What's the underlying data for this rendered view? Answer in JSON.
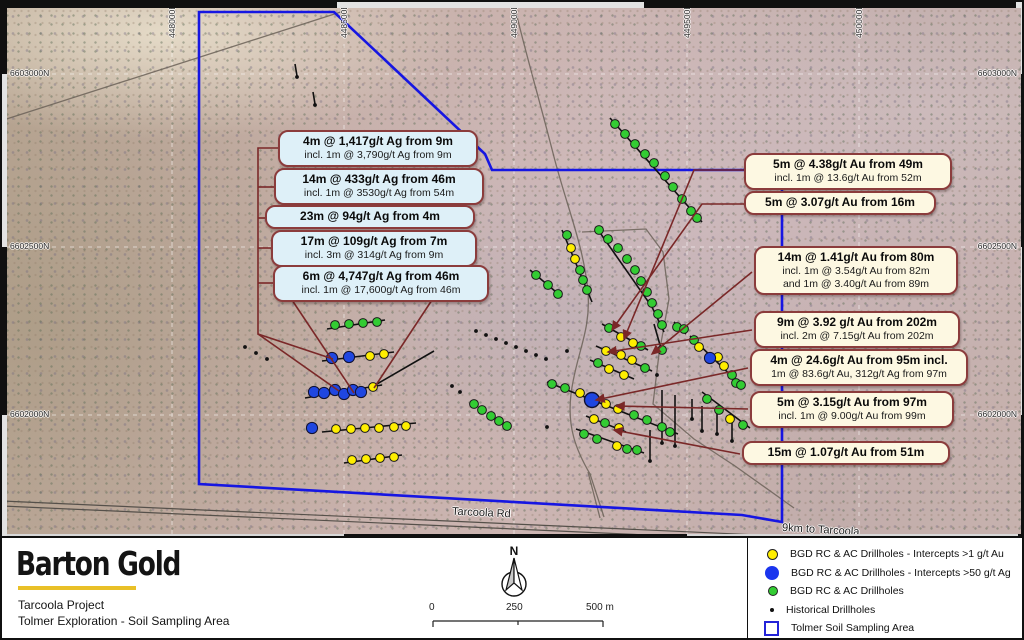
{
  "map": {
    "road_label": "Tarcoola Rd",
    "distance_label": "9km to Tarcoola",
    "grid": {
      "v": [
        170,
        342,
        512,
        685,
        857
      ],
      "h": [
        72,
        245,
        413
      ],
      "top_labels": [
        {
          "t": "448000E",
          "x": 170
        },
        {
          "t": "448500E",
          "x": 342
        },
        {
          "t": "449000E",
          "x": 512
        },
        {
          "t": "449500E",
          "x": 685
        },
        {
          "t": "450000E",
          "x": 857
        }
      ],
      "side_labels": [
        {
          "t": "6603000N",
          "y": 72
        },
        {
          "t": "6602500N",
          "y": 245
        },
        {
          "t": "6602000N",
          "y": 413
        }
      ]
    },
    "colors": {
      "boundary": "#1616e2",
      "leader": "#7a2828",
      "green_dot": "#33cc33",
      "yellow_dot": "#ffee00",
      "blue_dot": "#1f46e0",
      "historical_dot": "#111111"
    },
    "boundary_points": "197,10 332,10 483,152 490,168 780,168 780,520 740,513 197,482",
    "roads": [
      "M -5,120 L 345,8",
      "M 513,6 C 522,45 538,100 552,155 C 565,205 582,245 586,290 C 589,330 574,352 569,392 C 565,425 574,448 588,472 L 602,515",
      "M 580,230 L 644,227 L 661,250 L 667,297 L 657,352 L 651,402 L 692,437 L 733,464 L 792,506",
      "M 586,470 L 598,516"
    ],
    "main_road": [
      "M 0,499 L 1024,545",
      "M 0,504 L 1024,550"
    ],
    "traverses": [
      [
        325,
        327,
        383,
        318
      ],
      [
        320,
        359,
        392,
        350
      ],
      [
        303,
        396,
        380,
        383
      ],
      [
        368,
        386,
        432,
        349
      ],
      [
        320,
        430,
        414,
        421
      ],
      [
        342,
        461,
        400,
        453
      ],
      [
        608,
        116,
        700,
        220
      ],
      [
        560,
        228,
        590,
        300
      ],
      [
        594,
        225,
        650,
        305
      ],
      [
        650,
        305,
        662,
        330
      ],
      [
        528,
        268,
        560,
        295
      ],
      [
        600,
        322,
        646,
        348
      ],
      [
        652,
        322,
        660,
        350
      ],
      [
        672,
        320,
        684,
        332
      ],
      [
        688,
        334,
        742,
        386
      ],
      [
        594,
        344,
        650,
        369
      ],
      [
        588,
        358,
        632,
        377
      ],
      [
        545,
        380,
        676,
        432
      ],
      [
        584,
        414,
        624,
        430
      ],
      [
        574,
        427,
        642,
        451
      ],
      [
        700,
        390,
        748,
        426
      ],
      [
        660,
        388,
        660,
        440
      ],
      [
        673,
        393,
        673,
        443
      ],
      [
        690,
        397,
        690,
        416
      ],
      [
        700,
        404,
        700,
        428
      ],
      [
        715,
        407,
        715,
        431
      ],
      [
        730,
        414,
        730,
        438
      ],
      [
        648,
        428,
        648,
        458
      ],
      [
        293,
        62,
        295,
        74
      ],
      [
        311,
        90,
        313,
        102
      ]
    ],
    "drillholes": {
      "green": [
        [
          613,
          122
        ],
        [
          623,
          132
        ],
        [
          633,
          142
        ],
        [
          643,
          152
        ],
        [
          652,
          161
        ],
        [
          663,
          174
        ],
        [
          671,
          185
        ],
        [
          680,
          197
        ],
        [
          689,
          209
        ],
        [
          695,
          216
        ],
        [
          597,
          228
        ],
        [
          606,
          237
        ],
        [
          616,
          246
        ],
        [
          625,
          257
        ],
        [
          633,
          268
        ],
        [
          639,
          279
        ],
        [
          645,
          290
        ],
        [
          650,
          301
        ],
        [
          656,
          312
        ],
        [
          565,
          233
        ],
        [
          578,
          268
        ],
        [
          581,
          278
        ],
        [
          585,
          288
        ],
        [
          534,
          273
        ],
        [
          546,
          283
        ],
        [
          556,
          292
        ],
        [
          607,
          326
        ],
        [
          639,
          344
        ],
        [
          660,
          323
        ],
        [
          675,
          325
        ],
        [
          682,
          327
        ],
        [
          692,
          338
        ],
        [
          730,
          373
        ],
        [
          734,
          381
        ],
        [
          739,
          383
        ],
        [
          596,
          361
        ],
        [
          643,
          366
        ],
        [
          550,
          382
        ],
        [
          563,
          386
        ],
        [
          632,
          413
        ],
        [
          645,
          418
        ],
        [
          660,
          425
        ],
        [
          668,
          430
        ],
        [
          603,
          421
        ],
        [
          582,
          432
        ],
        [
          595,
          437
        ],
        [
          625,
          447
        ],
        [
          635,
          448
        ],
        [
          705,
          397
        ],
        [
          717,
          408
        ],
        [
          741,
          423
        ],
        [
          660,
          348
        ],
        [
          333,
          323
        ],
        [
          347,
          322
        ],
        [
          361,
          321
        ],
        [
          375,
          320
        ],
        [
          472,
          402
        ],
        [
          480,
          408
        ],
        [
          489,
          414
        ],
        [
          497,
          419
        ],
        [
          505,
          424
        ]
      ],
      "yellow": [
        [
          569,
          246
        ],
        [
          573,
          257
        ],
        [
          619,
          335
        ],
        [
          631,
          341
        ],
        [
          604,
          349
        ],
        [
          619,
          353
        ],
        [
          630,
          358
        ],
        [
          607,
          367
        ],
        [
          622,
          373
        ],
        [
          578,
          391
        ],
        [
          604,
          402
        ],
        [
          616,
          407
        ],
        [
          592,
          417
        ],
        [
          617,
          426
        ],
        [
          615,
          444
        ],
        [
          697,
          345
        ],
        [
          716,
          355
        ],
        [
          722,
          364
        ],
        [
          728,
          417
        ],
        [
          368,
          354
        ],
        [
          382,
          352
        ],
        [
          371,
          385
        ],
        [
          334,
          427
        ],
        [
          349,
          427
        ],
        [
          363,
          426
        ],
        [
          377,
          426
        ],
        [
          392,
          425
        ],
        [
          404,
          424
        ],
        [
          350,
          458
        ],
        [
          364,
          457
        ],
        [
          378,
          456
        ],
        [
          392,
          455
        ]
      ],
      "blue": [
        [
          330,
          356
        ],
        [
          347,
          355
        ],
        [
          312,
          390
        ],
        [
          322,
          391
        ],
        [
          333,
          388
        ],
        [
          342,
          392
        ],
        [
          351,
          388
        ],
        [
          359,
          390
        ],
        [
          310,
          426
        ],
        [
          708,
          356
        ]
      ],
      "blue_large": [
        [
          590,
          398
        ]
      ],
      "historical": [
        [
          474,
          329
        ],
        [
          484,
          333
        ],
        [
          494,
          337
        ],
        [
          504,
          341
        ],
        [
          514,
          345
        ],
        [
          524,
          349
        ],
        [
          534,
          353
        ],
        [
          544,
          357
        ],
        [
          243,
          345
        ],
        [
          254,
          351
        ],
        [
          265,
          357
        ],
        [
          295,
          75
        ],
        [
          313,
          103
        ],
        [
          660,
          441
        ],
        [
          673,
          444
        ],
        [
          690,
          417
        ],
        [
          700,
          429
        ],
        [
          715,
          432
        ],
        [
          730,
          439
        ],
        [
          648,
          459
        ],
        [
          655,
          373
        ],
        [
          458,
          390
        ],
        [
          450,
          384
        ],
        [
          565,
          349
        ],
        [
          545,
          425
        ]
      ]
    },
    "leaders": [
      {
        "pts": [
          [
            276,
            146
          ],
          [
            256,
            146
          ],
          [
            256,
            332
          ],
          [
            331,
            357
          ]
        ],
        "arrow": false
      },
      {
        "pts": [
          [
            272,
            185
          ],
          [
            256,
            185
          ]
        ],
        "arrow": false
      },
      {
        "pts": [
          [
            263,
            216
          ],
          [
            256,
            216
          ]
        ],
        "arrow": false
      },
      {
        "pts": [
          [
            269,
            246
          ],
          [
            256,
            246
          ]
        ],
        "arrow": false
      },
      {
        "pts": [
          [
            271,
            281
          ],
          [
            256,
            281
          ]
        ],
        "arrow": false
      },
      {
        "pts": [
          [
            256,
            332
          ],
          [
            337,
            389
          ]
        ],
        "arrow": false
      },
      {
        "pts": [
          [
            290,
            298
          ],
          [
            352,
            391
          ]
        ],
        "arrow": false
      },
      {
        "pts": [
          [
            430,
            298
          ],
          [
            372,
            386
          ]
        ],
        "arrow": false
      },
      {
        "pts": [
          [
            742,
            168
          ],
          [
            692,
            168
          ],
          [
            622,
            337
          ]
        ],
        "arrow": true
      },
      {
        "pts": [
          [
            742,
            202
          ],
          [
            700,
            202
          ],
          [
            610,
            328
          ]
        ],
        "arrow": true
      },
      {
        "pts": [
          [
            750,
            270
          ],
          [
            650,
            352
          ]
        ],
        "arrow": true
      },
      {
        "pts": [
          [
            750,
            328
          ],
          [
            606,
            350
          ]
        ],
        "arrow": true
      },
      {
        "pts": [
          [
            746,
            366
          ],
          [
            594,
            398
          ]
        ],
        "arrow": true
      },
      {
        "pts": [
          [
            746,
            407
          ],
          [
            614,
            404
          ]
        ],
        "arrow": true
      },
      {
        "pts": [
          [
            738,
            452
          ],
          [
            612,
            428
          ]
        ],
        "arrow": true
      }
    ]
  },
  "callouts": {
    "ag": [
      {
        "x": 276,
        "y": 128,
        "w": 180,
        "title": "4m @ 1,417g/t Ag from 9m",
        "sub": "incl. 1m @ 3,790g/t Ag from 9m"
      },
      {
        "x": 272,
        "y": 166,
        "w": 190,
        "title": "14m @ 433g/t Ag from 46m",
        "sub": "incl. 1m @ 3530g/t Ag from 54m"
      },
      {
        "x": 263,
        "y": 203,
        "w": 190,
        "title": "23m @ 94g/t Ag from 4m",
        "sub": ""
      },
      {
        "x": 269,
        "y": 228,
        "w": 186,
        "title": "17m @ 109g/t Ag from 7m",
        "sub": "incl. 3m @ 314g/t Ag from 9m"
      },
      {
        "x": 271,
        "y": 263,
        "w": 196,
        "title": "6m @ 4,747g/t Ag from 46m",
        "sub": "incl. 1m @ 17,600g/t Ag from 46m"
      }
    ],
    "au": [
      {
        "x": 742,
        "y": 151,
        "w": 188,
        "title": "5m @ 4.38g/t Au from 49m",
        "sub": "incl. 1m @ 13.6g/t Au from 52m"
      },
      {
        "x": 742,
        "y": 189,
        "w": 172,
        "title": "5m @ 3.07g/t Au from 16m",
        "sub": ""
      },
      {
        "x": 752,
        "y": 244,
        "w": 184,
        "title": "14m @ 1.41g/t Au from 80m",
        "sub": "incl. 1m @ 3.54g/t Au from 82m\nand 1m @ 3.40g/t Au from 89m"
      },
      {
        "x": 752,
        "y": 309,
        "w": 186,
        "title": "9m @ 3.92 g/t Au from 202m",
        "sub": "incl. 2m @ 7.15g/t Au from 202m"
      },
      {
        "x": 748,
        "y": 347,
        "w": 198,
        "title": "4m @ 24.6g/t Au from 95m incl.",
        "sub": "1m @ 83.6g/t Au, 312g/t Ag from 97m"
      },
      {
        "x": 748,
        "y": 389,
        "w": 184,
        "title": "5m @ 3.15g/t Au from 97m",
        "sub": "incl. 1m @ 9.00g/t Au from 99m"
      },
      {
        "x": 740,
        "y": 439,
        "w": 188,
        "title": "15m @ 1.07g/t Au from 51m",
        "sub": ""
      }
    ]
  },
  "footer": {
    "logo": "Barton Gold",
    "line1": "Tarcoola Project",
    "line2": "Tolmer Exploration - Soil Sampling Area",
    "north_label": "N",
    "scale_ticks": [
      "0",
      "250",
      "500 m"
    ]
  },
  "legend": {
    "items": [
      {
        "marker": "yellow",
        "label": "BGD RC & AC Drillholes - Intercepts >1 g/t Au"
      },
      {
        "marker": "blue",
        "label": "BGD RC & AC Drillholes - Intercepts >50 g/t Ag"
      },
      {
        "marker": "green",
        "label": "BGD RC & AC Drillholes"
      },
      {
        "marker": "black",
        "label": "Historical Drillholes"
      },
      {
        "marker": "bluesq",
        "label": "Tolmer Soil Sampling Area"
      }
    ]
  }
}
